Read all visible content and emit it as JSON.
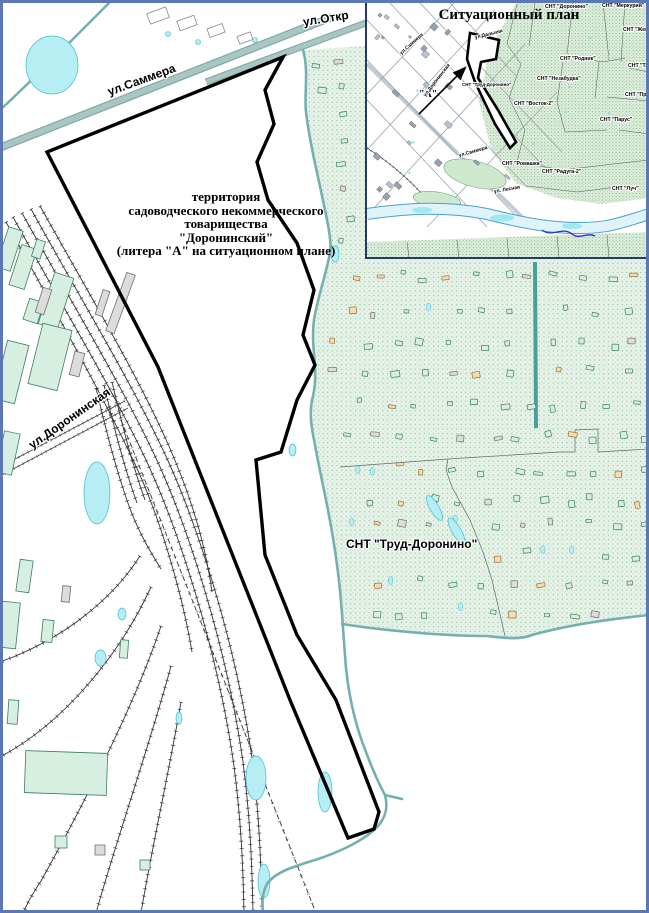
{
  "page": {
    "type_label": "cadastral situational map",
    "border_color": "#5b78b4",
    "background": "#ffffff"
  },
  "main_map": {
    "territory_label": {
      "lines": [
        "территория",
        "садоводческого некоммерческого",
        "товарищества",
        "\"Доронинский\"",
        "(литера \"А\" на ситуационном плане)"
      ]
    },
    "labels": [
      {
        "name": "street-label-sammera",
        "text": "ул.Саммера",
        "x": 108,
        "y": 86,
        "rot": -20,
        "size": 12,
        "halo": true
      },
      {
        "name": "street-label-otkr",
        "text": "ул.Откр",
        "x": 303,
        "y": 16,
        "rot": -9,
        "size": 12,
        "halo": true
      },
      {
        "name": "street-label-doroninskaya",
        "text": "ул.Доронинская",
        "x": 30,
        "y": 440,
        "rot": -35,
        "size": 12,
        "halo": true
      },
      {
        "name": "snt-trud-doronino-label",
        "text": "СНТ \"Труд-Доронино\"",
        "x": 346,
        "y": 538,
        "rot": 0,
        "size": 12,
        "halo": true
      }
    ],
    "colors": {
      "stream": "#74b0b0",
      "road_fill": "#aac6c4",
      "road_edge": "#7fa8a6",
      "hatch_bg": "#e6f2e8",
      "hatch_dot": "#8fbf98",
      "pond_fill": "#b6eef4",
      "pond_stroke": "#3bbcd0",
      "building_green": "#d6efe0",
      "building_green_stroke": "#3e7d64",
      "building_tan": "#f6dcae",
      "building_tan_stroke": "#96703a",
      "building_gray": "#dcdcdc",
      "building_gray_stroke": "#707070",
      "rail": "#333333",
      "boundary": "#000000"
    }
  },
  "inset": {
    "title": "Ситуационный план",
    "labels": [
      {
        "name": "inset-snt-doronino",
        "text": "СНТ \"Доронино\"",
        "x": 178,
        "y": 3,
        "rot": 0,
        "size": 5.2,
        "halo": true
      },
      {
        "name": "inset-snt-merkuriy",
        "text": "СНТ \"Меркурий\"",
        "x": 235,
        "y": 2,
        "rot": 0,
        "size": 5.2,
        "halo": true
      },
      {
        "name": "inset-snt-zhem",
        "text": "СНТ \"Жем",
        "x": 256,
        "y": 26,
        "rot": 0,
        "size": 5.2,
        "halo": true
      },
      {
        "name": "inset-snt-rodnik",
        "text": "СНТ \"Родник\"",
        "x": 193,
        "y": 55,
        "rot": 0,
        "size": 5.2,
        "halo": true
      },
      {
        "name": "inset-snt-tr",
        "text": "СНТ \"Тр",
        "x": 261,
        "y": 62,
        "rot": 0,
        "size": 5.2,
        "halo": true
      },
      {
        "name": "inset-snt-nezabudka",
        "text": "СНТ \"Незабудка\"",
        "x": 170,
        "y": 75,
        "rot": 0,
        "size": 5.2,
        "halo": true
      },
      {
        "name": "inset-snt-pr",
        "text": "СНТ \"Пр",
        "x": 258,
        "y": 91,
        "rot": 0,
        "size": 5.2,
        "halo": true
      },
      {
        "name": "inset-snt-vostok-2",
        "text": "СНТ \"Восток-2\"",
        "x": 147,
        "y": 100,
        "rot": 0,
        "size": 5.2,
        "halo": true
      },
      {
        "name": "inset-snt-parus",
        "text": "СНТ \"Парус\"",
        "x": 233,
        "y": 116,
        "rot": 0,
        "size": 5.2,
        "halo": true
      },
      {
        "name": "inset-snt-romashka",
        "text": "СНТ \"Ромашка\"",
        "x": 135,
        "y": 160,
        "rot": 0,
        "size": 5.2,
        "halo": true
      },
      {
        "name": "inset-snt-raduga-2",
        "text": "СНТ \"Радуга-2\"",
        "x": 175,
        "y": 168,
        "rot": 0,
        "size": 5.2,
        "halo": true
      },
      {
        "name": "inset-snt-luch",
        "text": "СНТ \"Луч\"",
        "x": 245,
        "y": 185,
        "rot": 0,
        "size": 5.2,
        "halo": true
      },
      {
        "name": "inset-snt-trud-doronino",
        "text": "СНТ \"Труд-Доронино\"",
        "x": 95,
        "y": 81,
        "rot": 0,
        "size": 4.5,
        "halo": true
      },
      {
        "name": "inset-litera-a",
        "text": "\"А\"",
        "x": 52,
        "y": 88,
        "rot": 0,
        "size": 10,
        "serif": true,
        "halo": true
      },
      {
        "name": "inset-street-sammera-1",
        "text": "ул.Саммера",
        "x": 34,
        "y": 50,
        "rot": -42,
        "size": 5,
        "halo": true
      },
      {
        "name": "inset-street-doroninskaya",
        "text": "ул.Доронинская",
        "x": 58,
        "y": 92,
        "rot": -52,
        "size": 5,
        "halo": true
      },
      {
        "name": "inset-street-dalnyaya",
        "text": "ул.Дальняя",
        "x": 108,
        "y": 34,
        "rot": -14,
        "size": 5,
        "halo": true
      },
      {
        "name": "inset-street-sammera-2",
        "text": "ул.Саммера",
        "x": 92,
        "y": 152,
        "rot": -16,
        "size": 5,
        "halo": true
      },
      {
        "name": "inset-street-lesnaya",
        "text": "ул. Лесная",
        "x": 127,
        "y": 188,
        "rot": -10,
        "size": 5,
        "halo": true
      }
    ],
    "border_color": "#263a66"
  },
  "generated": {
    "seed": 42,
    "building_mix": {
      "green": 0.72,
      "tan": 0.86
    }
  }
}
